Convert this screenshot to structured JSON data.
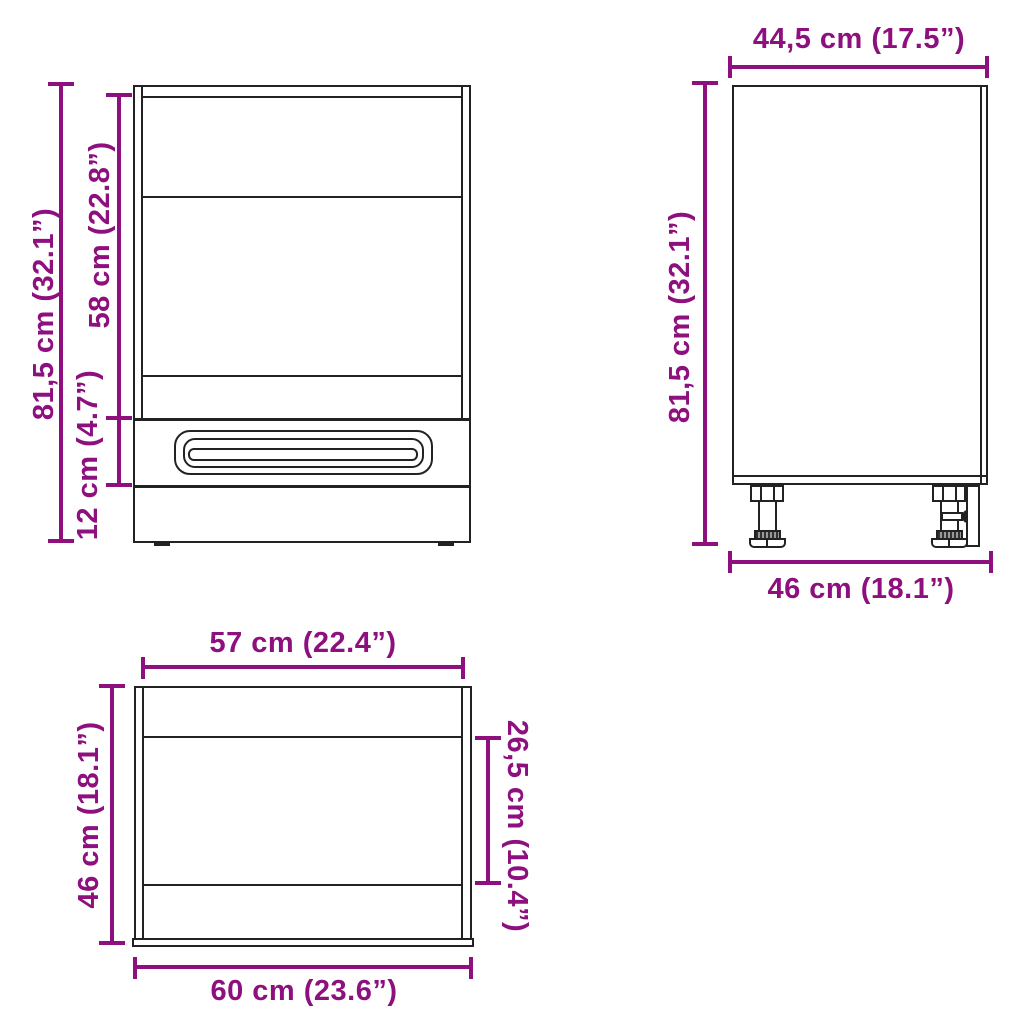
{
  "title": "Cabinet dimensions diagram",
  "colors": {
    "dimension": "#8D107E",
    "drawing": "#222222",
    "background": "#ffffff"
  },
  "views": {
    "front": {
      "name": "front-view",
      "overall_height": "81,5 cm (32.1”)",
      "niche_height": "58 cm (22.8”)",
      "drawer_height": "12 cm (4.7”)"
    },
    "side": {
      "name": "side-view",
      "width_top": "44,5 cm (17.5”)",
      "overall_height": "81,5 cm (32.1”)",
      "depth_bottom": "46 cm (18.1”)"
    },
    "top": {
      "name": "top-view",
      "inner_width": "57 cm (22.4”)",
      "depth": "46 cm (18.1”)",
      "partial_depth": "26,5 cm (10.4”)",
      "outer_width": "60 cm (23.6”)"
    }
  }
}
